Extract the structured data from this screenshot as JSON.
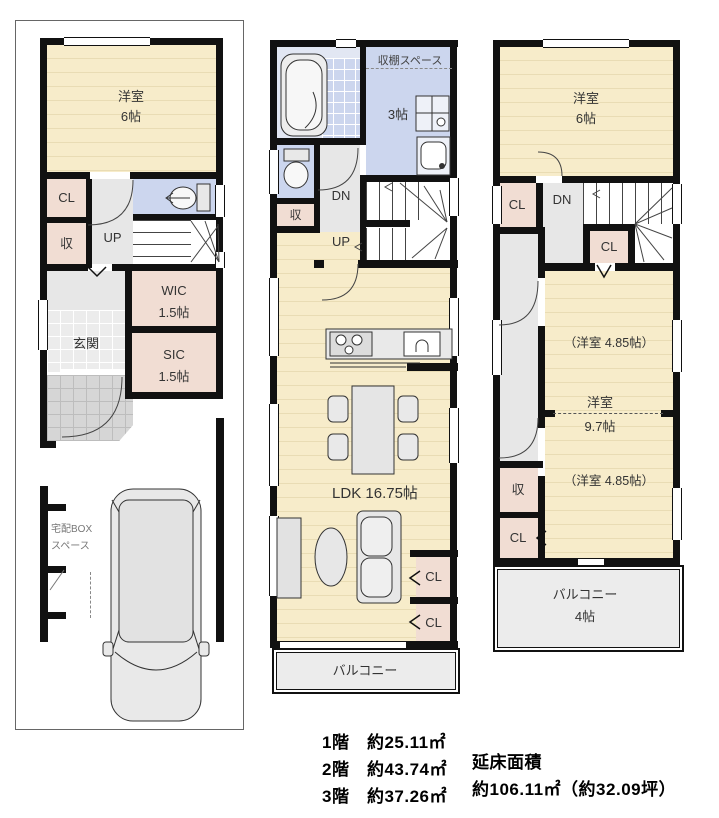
{
  "colors": {
    "wall": "#111111",
    "wood": "#f7ecca",
    "stripe": "#e9dcb4",
    "closet": "#f1ddd3",
    "wet": "#ccd6ee",
    "corridor": "#e7e7e7",
    "tile": "#ececec",
    "porch": "#d6d6d6",
    "balcony": "#ececec",
    "furn": "#e3e3e3"
  },
  "f1": {
    "room6_name": "洋室",
    "room6_size": "6帖",
    "cl": "CL",
    "shu": "収",
    "up": "UP",
    "wic_name": "WIC",
    "wic_size": "1.5帖",
    "sic_name": "SIC",
    "sic_size": "1.5帖",
    "genkan": "玄関",
    "box_line1": "宅配BOX",
    "box_line2": "スペース"
  },
  "f2": {
    "shelf": "収棚スペース",
    "room3": "3帖",
    "dn": "DN",
    "up": "UP",
    "shu": "収",
    "ldk": "LDK 16.75帖",
    "cl_a": "CL",
    "cl_b": "CL",
    "balcony": "バルコニー"
  },
  "f3": {
    "room6_name": "洋室",
    "room6_size": "6帖",
    "cl_a": "CL",
    "dn": "DN",
    "cl_b": "CL",
    "room_a": "（洋室 4.85帖）",
    "room_main_name": "洋室",
    "room_main_size": "9.7帖",
    "room_b": "（洋室 4.85帖）",
    "shu": "収",
    "cl_c": "CL",
    "balcony": "バルコニー",
    "balcony_size": "4帖"
  },
  "summary": {
    "f1_area": "1階　約25.11㎡",
    "f2_area": "2階　約43.74㎡",
    "f3_area": "3階　約37.26㎡",
    "total_label": "延床面積",
    "total_value": "約106.11㎡（約32.09坪）"
  }
}
